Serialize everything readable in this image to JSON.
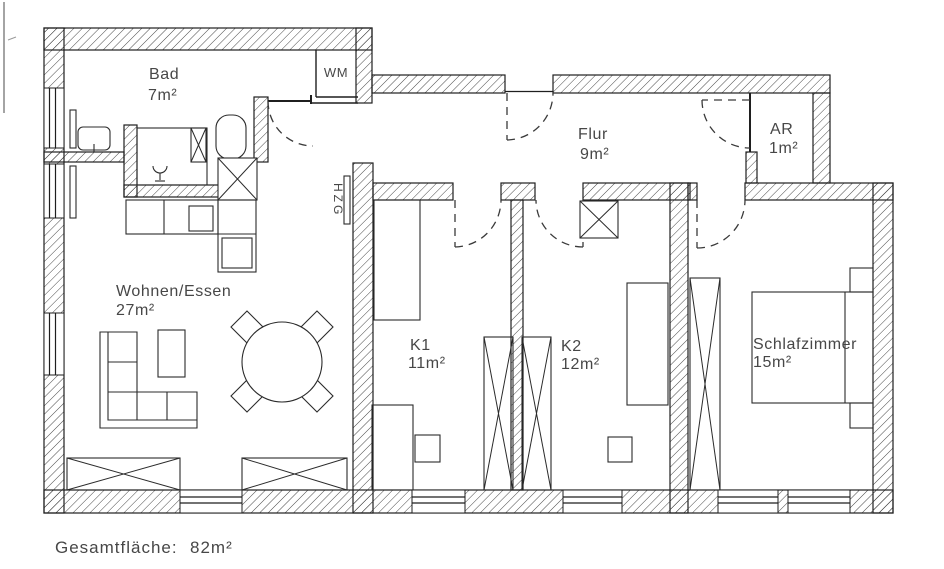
{
  "plan": {
    "background": "#ffffff",
    "line_color": "#1f1f1f",
    "text_color": "#474747",
    "rooms": {
      "bad": {
        "name": "Bad",
        "area": "7m²"
      },
      "flur": {
        "name": "Flur",
        "area": "9m²"
      },
      "ar": {
        "name": "AR",
        "area": "1m²"
      },
      "wohnen": {
        "name": "Wohnen/Essen",
        "area": "27m²"
      },
      "k1": {
        "name": "K1",
        "area": "11m²"
      },
      "k2": {
        "name": "K2",
        "area": "12m²"
      },
      "schlafzimmer": {
        "name": "Schlafzimmer",
        "area": "15m²"
      }
    },
    "labels": {
      "wm": "WM",
      "hzg": "HZG"
    },
    "footer": {
      "label": "Gesamtfläche:",
      "value": "82m²"
    }
  }
}
